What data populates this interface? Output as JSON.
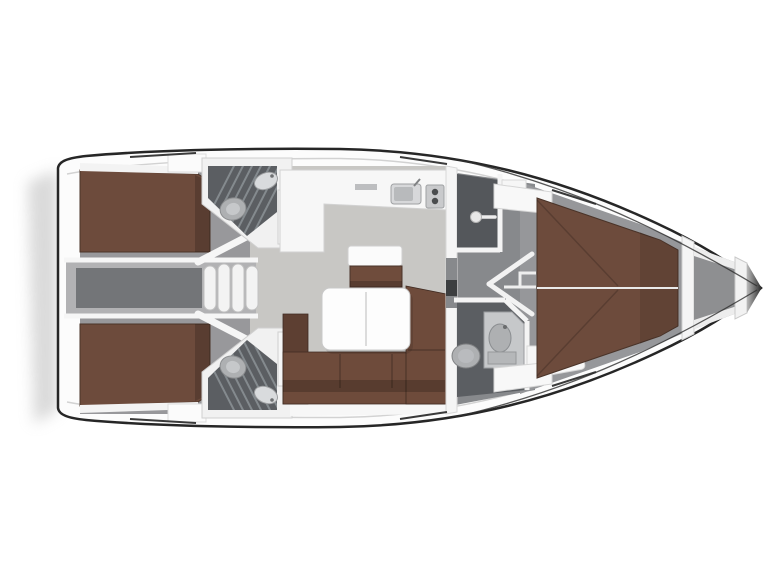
{
  "page": {
    "title": "Sailing yacht interior floor plan (top view, bow right)"
  },
  "colors": {
    "background": "#ffffff",
    "hull_outline": "#262626",
    "hull_fill": "#fcfcfc",
    "inner_rail": "#d2d2d2",
    "shadow": "#c6c6c6",
    "aft_floor": "#98989b",
    "salon_floor": "#c8c7c4",
    "corridor_floor": "#87898c",
    "fwd_floor": "#96979a",
    "head_floor": "#5b5e62",
    "shower_floor": "#54575b",
    "engine_outer": "#b2b2b4",
    "engine_inner": "#737578",
    "berth_brown": "#6d4b3c",
    "sofa_brown": "#6e4b3b",
    "sofa_arm_brown": "#5d3f32",
    "seat_brown": "#6f4c3c",
    "wall_white": "#f5f5f5",
    "door_white": "#f2f2f2",
    "table_white": "#fdfdfd",
    "fixture_light": "#d9dbdd",
    "fixture_mid": "#aeb0b2",
    "fixture_dark": "#85878a",
    "locker_floor": "#8e8f91",
    "hatch_line": "#3a3a3a",
    "grate_line": "#848a8e",
    "dark_panel": "#3c3e40"
  },
  "areas": [
    {
      "id": "aft-port-cabin",
      "label": "Aft cabin port with double berth"
    },
    {
      "id": "aft-starboard-cabin",
      "label": "Aft cabin starboard with double berth"
    },
    {
      "id": "engine-compartment",
      "label": "Engine compartment between aft cabins"
    },
    {
      "id": "companionway-steps",
      "label": "Companionway steps"
    },
    {
      "id": "aft-port-head",
      "label": "Aft port head with toilet, sink and shower grate"
    },
    {
      "id": "aft-starboard-head",
      "label": "Aft starboard head with toilet, sink and shower grate"
    },
    {
      "id": "galley",
      "label": "L-shaped galley with sink and stove"
    },
    {
      "id": "salon",
      "label": "Salon with L-sofa, dining table and bench seat"
    },
    {
      "id": "shower-room",
      "label": "Separate shower compartment"
    },
    {
      "id": "forward-head",
      "label": "Forward head with toilet and vanity"
    },
    {
      "id": "forward-cabin",
      "label": "Forward cabin with V-berth"
    },
    {
      "id": "anchor-locker",
      "label": "Bow anchor locker"
    }
  ]
}
